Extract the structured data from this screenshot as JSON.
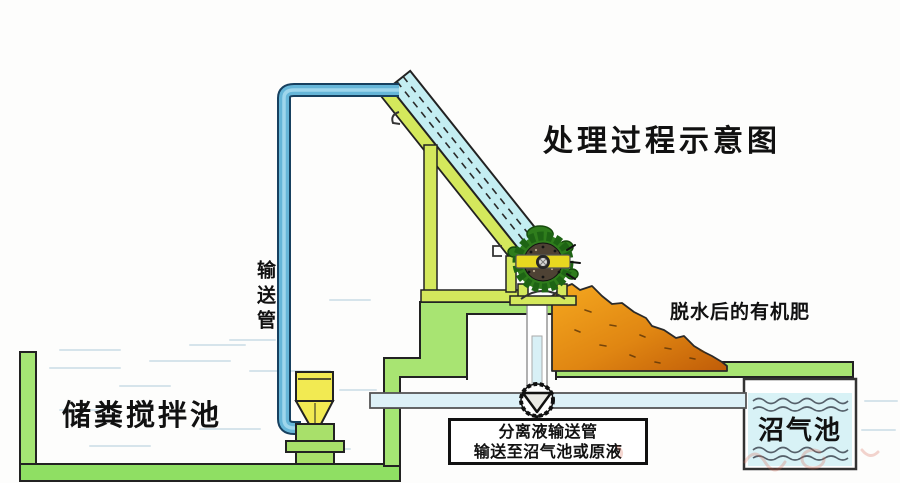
{
  "diagram": {
    "title": "处理过程示意图",
    "labels": {
      "conveying_pipe": "输送管",
      "storage_tank": "储粪搅拌池",
      "organic_fertilizer": "脱水后的有机肥",
      "biogas_tank": "沼气池",
      "note_line1": "分离液输送管",
      "note_line2": "输送至沼气池或原液"
    },
    "colors": {
      "wall_green": "#a5e574",
      "platform_green": "#a8e472",
      "floor_green": "#8fdf63",
      "frame_yellow_green": "#d4e85c",
      "pipe_blue": "#66b6d8",
      "pipe_blue_dark": "#17405f",
      "pipe_blue_light": "#9ed6ec",
      "conveyor_cyan": "#c4eef2",
      "water_cyan": "#d8f2f6",
      "pile_orange_light": "#f5a81f",
      "pile_orange_dark": "#c05c08",
      "pump_yellow": "#f2ea52",
      "wheel_green_dark": "#1e6414",
      "wheel_green": "#2f7d1c",
      "outline": "#222222"
    }
  }
}
